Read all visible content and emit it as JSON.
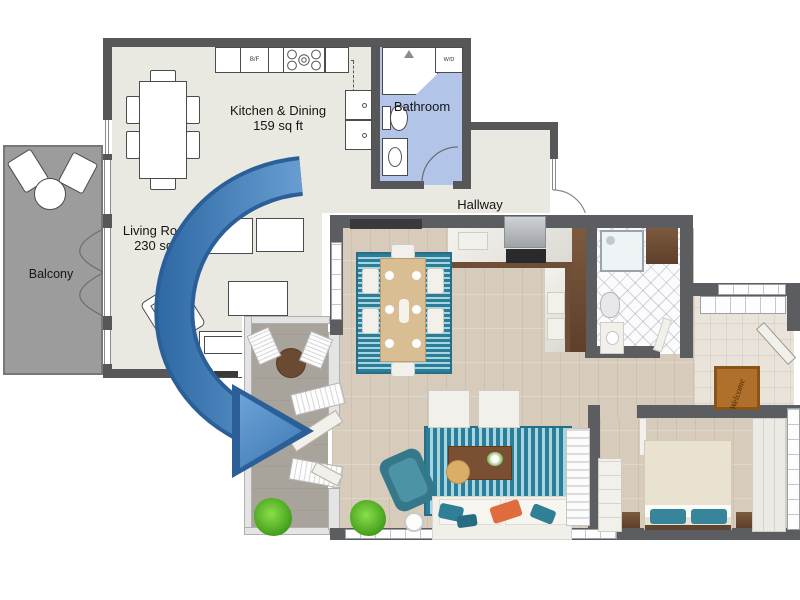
{
  "title": "2D floor plan transformed into 3D floor plan",
  "plan2d": {
    "rooms": {
      "kitchen_dining": {
        "label": "Kitchen & Dining",
        "area": "159 sq ft"
      },
      "living_room": {
        "label": "Living Room",
        "area": "230 sq ft"
      },
      "bathroom": {
        "label": "Bathroom"
      },
      "hallway": {
        "label": "Hallway"
      },
      "balcony": {
        "label": "Balcony"
      }
    },
    "appliances": {
      "fridge": "B/F",
      "washer_dryer": "W/D"
    },
    "colors": {
      "wall": "#57575a",
      "floor": "#eae9e1",
      "bathroom_floor": "#b2c5e9",
      "balcony_floor": "#9c9c9c"
    }
  },
  "plan3d": {
    "doormat": "Welcome",
    "colors": {
      "wall": "#5c5d61",
      "wood_floor": "#d7ccbc",
      "rug_teal": "#2c7e98",
      "cabinet_brown": "#6f4e37",
      "accent_teal": "#35788a",
      "accent_orange": "#e06b3c",
      "plant_green": "#49a41f",
      "balcony_floor": "#a8a49b"
    }
  },
  "arrow": {
    "fill": "#4b87c2",
    "outline": "#2b5f98"
  }
}
